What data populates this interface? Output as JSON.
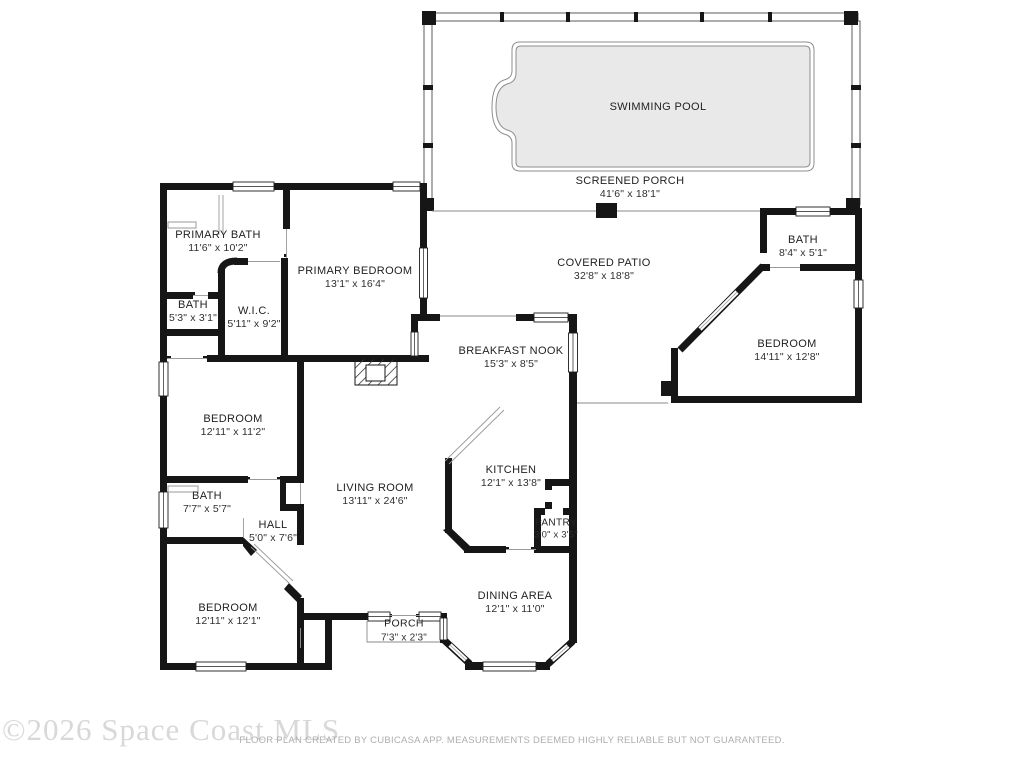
{
  "floor_plan": {
    "rooms": [
      {
        "name": "SWIMMING POOL",
        "dims": ""
      },
      {
        "name": "SCREENED PORCH",
        "dims": "41'6\" x 18'1\""
      },
      {
        "name": "PRIMARY BATH",
        "dims": "11'6\" x 10'2\""
      },
      {
        "name": "PRIMARY BEDROOM",
        "dims": "13'1\" x 16'4\""
      },
      {
        "name": "BATH",
        "dims": "5'3\" x 3'1\""
      },
      {
        "name": "W.I.C.",
        "dims": "5'11\" x 9'2\""
      },
      {
        "name": "COVERED PATIO",
        "dims": "32'8\" x 18'8\""
      },
      {
        "name": "BATH",
        "dims": "8'4\" x 5'1\""
      },
      {
        "name": "BEDROOM",
        "dims": "14'11\" x 12'8\""
      },
      {
        "name": "BREAKFAST NOOK",
        "dims": "15'3\" x 8'5\""
      },
      {
        "name": "KITCHEN",
        "dims": "12'1\" x 13'8\""
      },
      {
        "name": "LIVING ROOM",
        "dims": "13'11\" x 24'6\""
      },
      {
        "name": "PANTRY",
        "dims": "3'0\" x 3'5\""
      },
      {
        "name": "BEDROOM",
        "dims": "12'11\" x 11'2\""
      },
      {
        "name": "BATH",
        "dims": "7'7\" x 5'7\""
      },
      {
        "name": "HALL",
        "dims": "5'0\" x 7'6\""
      },
      {
        "name": "BEDROOM",
        "dims": "12'11\" x 12'1\""
      },
      {
        "name": "DINING AREA",
        "dims": "12'1\" x 11'0\""
      },
      {
        "name": "PORCH",
        "dims": "7'3\" x 2'3\""
      }
    ],
    "watermark": "©2026 Space Coast MLS",
    "footer": "FLOOR PLAN CREATED BY CUBICASA APP. MEASUREMENTS DEEMED HIGHLY RELIABLE BUT NOT GUARANTEED.",
    "colors": {
      "wall": "#161616",
      "pool_fill": "#e9e9e9",
      "text": "#222222",
      "watermark": "#d8d8d8"
    }
  }
}
